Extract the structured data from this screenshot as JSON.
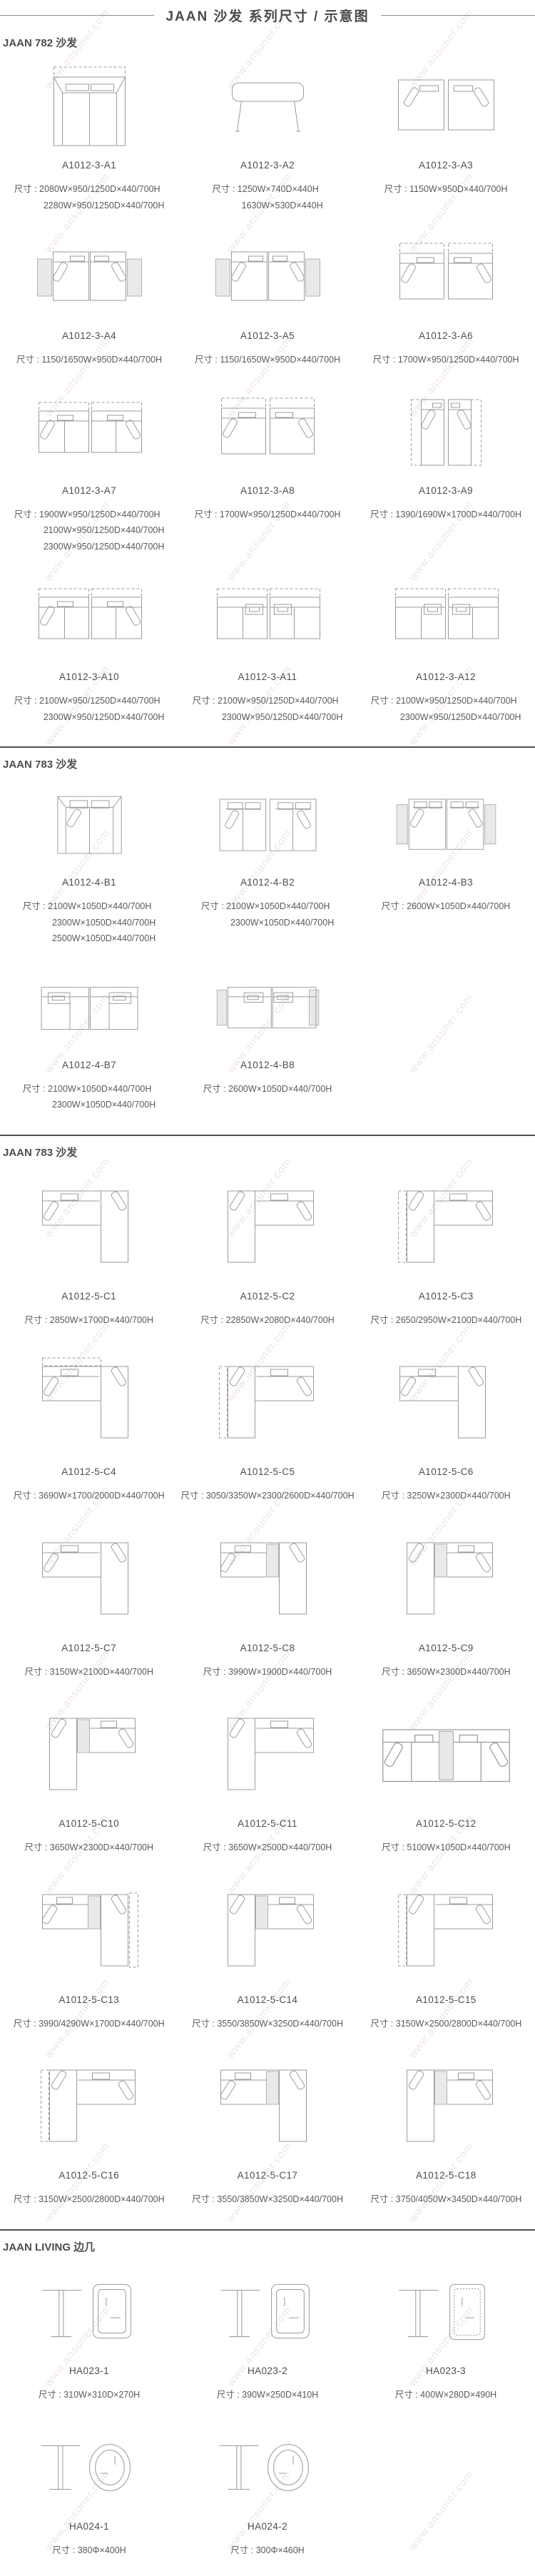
{
  "page_title": "JAAN  沙发 系列尺寸 / 示意图",
  "dim_label": "尺寸 : ",
  "watermark": "www.ansuner.com",
  "colors": {
    "line_art": "#9b9b9b",
    "gray_panel": "#e9e9e9",
    "divider": "#4f4f4f",
    "text": "#555555"
  },
  "sections": [
    {
      "title": "JAAN 782 沙发",
      "items": [
        {
          "model": "A1012-3-A1",
          "figure": "sofa-front",
          "dims": [
            "2080W×950/1250D×440/700H",
            "2280W×950/1250D×440/700H"
          ]
        },
        {
          "model": "A1012-3-A2",
          "figure": "bench",
          "dims": [
            "1250W×740D×440H",
            "1630W×530D×440H"
          ]
        },
        {
          "model": "A1012-3-A3",
          "figure": "pair-corner",
          "dims": [
            "1150W×950D×440/700H"
          ]
        },
        {
          "model": "A1012-3-A4",
          "figure": "pair-gray",
          "dims": [
            "1150/1650W×950D×440/700H"
          ]
        },
        {
          "model": "A1012-3-A5",
          "figure": "pair-gray",
          "dims": [
            "1150/1650W×950D×440/700H"
          ]
        },
        {
          "model": "A1012-3-A6",
          "figure": "pair-dashed",
          "dims": [
            "1700W×950/1250D×440/700H"
          ]
        },
        {
          "model": "A1012-3-A7",
          "figure": "pair-wide-dashed",
          "dims": [
            "1900W×950/1250D×440/700H",
            "2100W×950/1250D×440/700H",
            "2300W×950/1250D×440/700H"
          ]
        },
        {
          "model": "A1012-3-A8",
          "figure": "pair-dashed",
          "dims": [
            "1700W×950/1250D×440/700H"
          ]
        },
        {
          "model": "A1012-3-A9",
          "figure": "pair-narrow-dashed",
          "dims": [
            "1390/1690W×1700D×440/700H"
          ]
        },
        {
          "model": "A1012-3-A10",
          "figure": "pair-wide-dashed",
          "dims": [
            "2100W×950/1250D×440/700H",
            "2300W×950/1250D×440/700H"
          ]
        },
        {
          "model": "A1012-3-A11",
          "figure": "pair-wide-dashed2",
          "dims": [
            "2100W×950/1250D×440/700H",
            "2300W×950/1250D×440/700H"
          ]
        },
        {
          "model": "A1012-3-A12",
          "figure": "pair-wide-dashed2",
          "dims": [
            "2100W×950/1250D×440/700H",
            "2300W×950/1250D×440/700H"
          ]
        }
      ]
    },
    {
      "title": "JAAN 783 沙发",
      "items": [
        {
          "model": "A1012-4-B1",
          "figure": "sofa-top-1",
          "dims": [
            "2100W×1050D×440/700H",
            "2300W×1050D×440/700H",
            "2500W×1050D×440/700H"
          ]
        },
        {
          "model": "A1012-4-B2",
          "figure": "sofa-top-2",
          "dims": [
            "2100W×1050D×440/700H",
            "2300W×1050D×440/700H"
          ]
        },
        {
          "model": "A1012-4-B3",
          "figure": "sofa-top-2-gray",
          "dims": [
            "2600W×1050D×440/700H"
          ]
        },
        {
          "model": "A1012-4-B7",
          "figure": "chaise-pair",
          "dims": [
            "2100W×1050D×440/700H",
            "2300W×1050D×440/700H"
          ]
        },
        {
          "model": "A1012-4-B8",
          "figure": "chaise-pair-gray",
          "dims": [
            "2600W×1050D×440/700H"
          ]
        }
      ]
    },
    {
      "title": "JAAN 783 沙发",
      "items": [
        {
          "model": "A1012-5-C1",
          "figure": "l-right",
          "dims": [
            "2850W×1700D×440/700H"
          ]
        },
        {
          "model": "A1012-5-C2",
          "figure": "l-left",
          "dims": [
            "22850W×2080D×440/700H"
          ]
        },
        {
          "model": "A1012-5-C3",
          "figure": "l-left-dashed",
          "dims": [
            "2650/2950W×2100D×440/700H"
          ]
        },
        {
          "model": "A1012-5-C4",
          "figure": "l-right-dashed",
          "dims": [
            "3690W×1700/2000D×440/700H"
          ]
        },
        {
          "model": "A1012-5-C5",
          "figure": "l-left-dashed",
          "dims": [
            "3050/3350W×2300/2600D×440/700H"
          ]
        },
        {
          "model": "A1012-5-C6",
          "figure": "l-right",
          "dims": [
            "3250W×2300D×440/700H"
          ]
        },
        {
          "model": "A1012-5-C7",
          "figure": "l-right",
          "dims": [
            "3150W×2100D×440/700H"
          ]
        },
        {
          "model": "A1012-5-C8",
          "figure": "l-right-gray",
          "dims": [
            "3990W×1900D×440/700H"
          ]
        },
        {
          "model": "A1012-5-C9",
          "figure": "l-left-gray",
          "dims": [
            "3650W×2300D×440/700H"
          ]
        },
        {
          "model": "A1012-5-C10",
          "figure": "l-left-gray",
          "dims": [
            "3650W×2300D×440/700H"
          ]
        },
        {
          "model": "A1012-5-C11",
          "figure": "l-left",
          "dims": [
            "3650W×2500D×440/700H"
          ]
        },
        {
          "model": "A1012-5-C12",
          "figure": "sofa-long-gray",
          "dims": [
            "5100W×1050D×440/700H"
          ]
        },
        {
          "model": "A1012-5-C13",
          "figure": "l-right-gray-dashed",
          "dims": [
            "3990/4290W×1700D×440/700H"
          ]
        },
        {
          "model": "A1012-5-C14",
          "figure": "l-left-gray",
          "dims": [
            "3550/3850W×3250D×440/700H"
          ]
        },
        {
          "model": "A1012-5-C15",
          "figure": "l-left-dashed",
          "dims": [
            "3150W×2500/2800D×440/700H"
          ]
        },
        {
          "model": "A1012-5-C16",
          "figure": "l-left-dashed",
          "dims": [
            "3150W×2500/2800D×440/700H"
          ]
        },
        {
          "model": "A1012-5-C17",
          "figure": "l-right-gray",
          "dims": [
            "3550/3850W×3250D×440/700H"
          ]
        },
        {
          "model": "A1012-5-C18",
          "figure": "l-left-gray",
          "dims": [
            "3750/4050W×3450D×440/700H"
          ]
        }
      ]
    },
    {
      "title": "JAAN LIVING 边几",
      "items": [
        {
          "model": "HA023-1",
          "figure": "side-table",
          "dims": [
            "310W×310D×270H"
          ]
        },
        {
          "model": "HA023-2",
          "figure": "side-table",
          "dims": [
            "390W×250D×410H"
          ]
        },
        {
          "model": "HA023-3",
          "figure": "side-table-dotted",
          "dims": [
            "400W×280D×490H"
          ]
        },
        {
          "model": "HA024-1",
          "figure": "round-table",
          "dims": [
            "380Φ×400H"
          ]
        },
        {
          "model": "HA024-2",
          "figure": "round-table",
          "dims": [
            "300Φ×460H"
          ]
        }
      ]
    }
  ]
}
